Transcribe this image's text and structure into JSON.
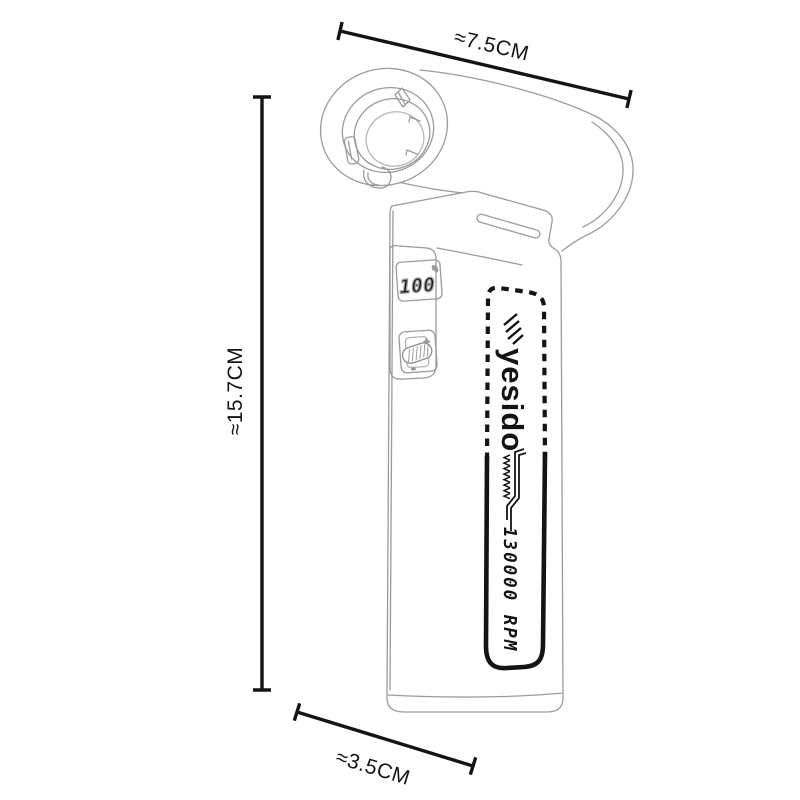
{
  "diagram": {
    "dimensions": {
      "width_label": "≈7.5CM",
      "height_label": "≈15.7CM",
      "depth_label": "≈3.5CM"
    },
    "product": {
      "display": {
        "value": "100",
        "unit": "%"
      },
      "controls": {
        "plus_label": "+",
        "minus_label": "-"
      },
      "label_panel": {
        "brand": "yesido",
        "rpm_text": "130000 RPM"
      }
    },
    "colors": {
      "background": "#ffffff",
      "outline_gray": "#9b9b9b",
      "outline_light": "#b5b5b5",
      "ink_black": "#141414"
    }
  }
}
